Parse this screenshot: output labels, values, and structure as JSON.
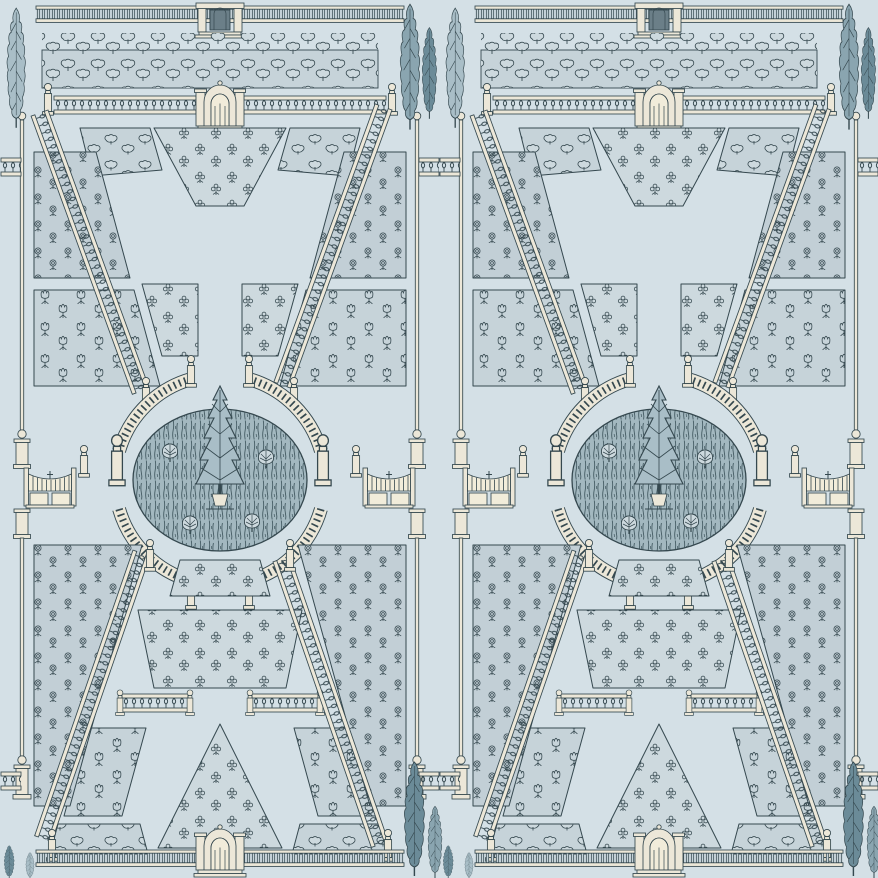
{
  "artwork": {
    "kind": "wallpaper-pattern",
    "subject": "Formal garden parterre toile, engraved style",
    "repeat_count": 2,
    "motif_elements": [
      "top-balustrade-with-aedicule",
      "topiary-border-bed",
      "arched-garden-entrance",
      "diagonal-balustrades",
      "parterre-flower-beds",
      "central-oval-lawn",
      "central-cypress-tree",
      "curved-balustrade-ring",
      "side-garden-gates",
      "boundary-pole-fences",
      "cypress-trees",
      "bottom-balustrade-with-arched-gate"
    ]
  },
  "colors": {
    "background": "#d4e0e6",
    "ink": "#35484f",
    "ink_soft": "#6b7f88",
    "bed_fill": "#c6d3d9",
    "bed_fill_light": "#cdd9de",
    "bed_fill_rose": "#c2cfd6",
    "oval_fill": "#a3b8c0",
    "oval_hatch": "#3f565e",
    "stone_cream": "#ece7d8",
    "stone_shadow": "#b2a98f",
    "gate_ivory": "#f1ecda",
    "cypress_light": "#a9bec7",
    "cypress_medium": "#8aa5b0",
    "cypress_dark": "#6b8b98"
  }
}
